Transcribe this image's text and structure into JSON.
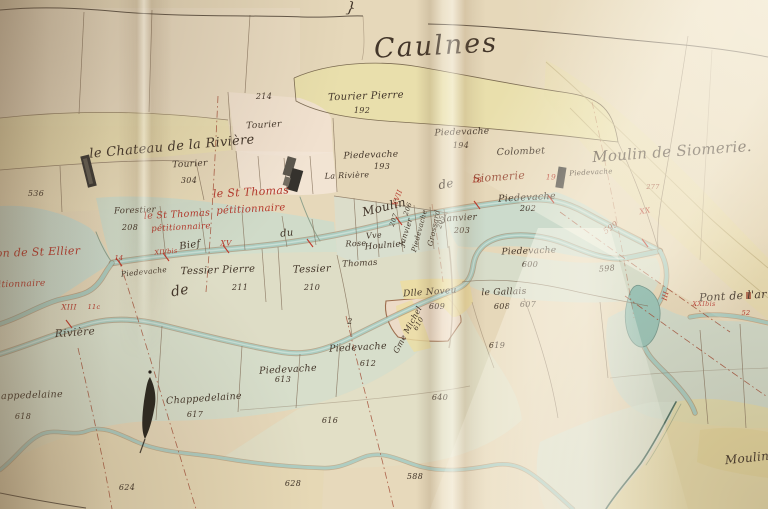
{
  "map": {
    "title": "Caulnes",
    "palette": {
      "ink": "#43362a",
      "red": "#b5382c",
      "redbrown": "#94432e",
      "brown": "#6b503a",
      "paper": "#e4d6b8",
      "water": "#abccc0",
      "meadow": "#cfdfd0",
      "parcel_yellow": "#e9dfaa",
      "parcel_pink": "#f1e1d0"
    },
    "labels": [
      {
        "t": "Caulnes",
        "x": 436,
        "y": 46,
        "fs": 27,
        "c": "ink",
        "r": -3,
        "sp": 2,
        "n": "map-title"
      },
      {
        "t": "}",
        "x": 351,
        "y": 8,
        "fs": 15,
        "c": "ink",
        "r": 8,
        "n": "margin-mark"
      },
      {
        "t": "Moulin de Siomerie.",
        "x": 672,
        "y": 152,
        "fs": 15,
        "c": "ink",
        "r": -4,
        "n": "place-name"
      },
      {
        "t": "le Chateau de la Rivière",
        "x": 172,
        "y": 147,
        "fs": 13,
        "c": "ink",
        "r": -5,
        "n": "place-name"
      },
      {
        "t": "214",
        "x": 264,
        "y": 97,
        "fs": 8,
        "c": "ink"
      },
      {
        "t": "Tourier",
        "x": 264,
        "y": 126,
        "fs": 9,
        "c": "ink",
        "r": -3
      },
      {
        "t": "Tourier Pierre",
        "x": 366,
        "y": 97,
        "fs": 10,
        "c": "ink",
        "r": -2
      },
      {
        "t": "192",
        "x": 362,
        "y": 111,
        "fs": 8,
        "c": "ink"
      },
      {
        "t": "Piedevache",
        "x": 462,
        "y": 133,
        "fs": 9,
        "c": "ink",
        "r": -2
      },
      {
        "t": "194",
        "x": 461,
        "y": 146,
        "fs": 8,
        "c": "ink"
      },
      {
        "t": "Piedevache",
        "x": 371,
        "y": 156,
        "fs": 9,
        "c": "ink",
        "r": -2
      },
      {
        "t": "193",
        "x": 382,
        "y": 167,
        "fs": 8,
        "c": "ink"
      },
      {
        "t": "La Rivière",
        "x": 347,
        "y": 176,
        "fs": 8,
        "c": "ink",
        "r": -2
      },
      {
        "t": "Colombet",
        "x": 521,
        "y": 152,
        "fs": 9.5,
        "c": "ink",
        "r": -2
      },
      {
        "t": "Piedevache",
        "x": 591,
        "y": 173,
        "fs": 7,
        "c": "ink",
        "r": -3
      },
      {
        "t": "Tourier",
        "x": 190,
        "y": 165,
        "fs": 9,
        "c": "ink",
        "r": -3
      },
      {
        "t": "304",
        "x": 189,
        "y": 181,
        "fs": 8,
        "c": "ink"
      },
      {
        "t": "536",
        "x": 36,
        "y": 194,
        "fs": 8,
        "c": "ink"
      },
      {
        "t": "Forestier",
        "x": 135,
        "y": 211,
        "fs": 8.5,
        "c": "ink",
        "r": -2
      },
      {
        "t": "208",
        "x": 130,
        "y": 228,
        "fs": 8,
        "c": "ink"
      },
      {
        "t": "le St Thomas",
        "x": 251,
        "y": 192,
        "fs": 11,
        "c": "red",
        "r": -3,
        "n": "petitioner-annotation"
      },
      {
        "t": "pétitionnaire",
        "x": 251,
        "y": 210,
        "fs": 10,
        "c": "red",
        "r": -3,
        "n": "petitioner-annotation"
      },
      {
        "t": "le St Thomas",
        "x": 177,
        "y": 215,
        "fs": 9.5,
        "c": "red",
        "r": -3,
        "n": "petitioner-annotation"
      },
      {
        "t": "pétitionnaire",
        "x": 181,
        "y": 228,
        "fs": 8.5,
        "c": "red",
        "r": -3,
        "n": "petitioner-annotation"
      },
      {
        "t": "on de St Ellier",
        "x": 38,
        "y": 252,
        "fs": 11,
        "c": "red",
        "r": -2,
        "n": "petitioner-annotation"
      },
      {
        "t": "titionnaire",
        "x": 20,
        "y": 285,
        "fs": 9,
        "c": "red",
        "r": -2,
        "n": "petitioner-annotation"
      },
      {
        "t": "Bief",
        "x": 190,
        "y": 246,
        "fs": 10,
        "c": "ink",
        "r": -8,
        "n": "canal-label"
      },
      {
        "t": "du",
        "x": 287,
        "y": 234,
        "fs": 10,
        "c": "ink",
        "r": -6,
        "n": "canal-label"
      },
      {
        "t": "Moulin",
        "x": 384,
        "y": 207,
        "fs": 12,
        "c": "ink",
        "r": -14,
        "n": "canal-label"
      },
      {
        "t": "de",
        "x": 446,
        "y": 184,
        "fs": 12,
        "c": "ink",
        "r": -10,
        "n": "canal-label"
      },
      {
        "t": "Siomerie",
        "x": 499,
        "y": 177,
        "fs": 11,
        "c": "redbrown",
        "r": -4,
        "n": "canal-label"
      },
      {
        "t": "XIVbis",
        "x": 166,
        "y": 252,
        "fs": 6.5,
        "c": "red",
        "r": -5,
        "n": "station-numeral"
      },
      {
        "t": "XV",
        "x": 226,
        "y": 243,
        "fs": 7.5,
        "c": "red",
        "n": "station-numeral"
      },
      {
        "t": "XVII",
        "x": 398,
        "y": 198,
        "fs": 7,
        "c": "red",
        "r": -70,
        "n": "station-numeral"
      },
      {
        "t": "18",
        "x": 477,
        "y": 180,
        "fs": 7.5,
        "c": "red",
        "n": "station-numeral"
      },
      {
        "t": "19",
        "x": 551,
        "y": 177,
        "fs": 7.5,
        "c": "red",
        "n": "station-numeral"
      },
      {
        "t": "XX",
        "x": 645,
        "y": 211,
        "fs": 7.5,
        "c": "red",
        "r": -10,
        "n": "station-numeral"
      },
      {
        "t": "XIII",
        "x": 69,
        "y": 307,
        "fs": 7.5,
        "c": "red",
        "n": "station-numeral"
      },
      {
        "t": "11c",
        "x": 94,
        "y": 307,
        "fs": 6.5,
        "c": "red",
        "n": "station-numeral"
      },
      {
        "t": "14",
        "x": 119,
        "y": 258,
        "fs": 6.5,
        "c": "red",
        "n": "station-numeral"
      },
      {
        "t": "XXIbis",
        "x": 704,
        "y": 304,
        "fs": 6.5,
        "c": "red",
        "n": "station-numeral"
      },
      {
        "t": "52",
        "x": 746,
        "y": 313,
        "fs": 6.5,
        "c": "red",
        "n": "station-numeral"
      },
      {
        "t": "III",
        "x": 666,
        "y": 296,
        "fs": 7,
        "c": "red",
        "r": -75,
        "n": "station-numeral"
      },
      {
        "t": "Piedevache",
        "x": 527,
        "y": 198,
        "fs": 9.5,
        "c": "ink",
        "r": -3
      },
      {
        "t": "202",
        "x": 528,
        "y": 209,
        "fs": 8,
        "c": "ink"
      },
      {
        "t": "Janvier",
        "x": 460,
        "y": 219,
        "fs": 9,
        "c": "ink",
        "r": -3
      },
      {
        "t": "203",
        "x": 462,
        "y": 231,
        "fs": 8,
        "c": "ink"
      },
      {
        "t": "Janvier",
        "x": 406,
        "y": 232,
        "fs": 7.5,
        "c": "ink",
        "r": -72
      },
      {
        "t": "207",
        "x": 394,
        "y": 220,
        "fs": 6.5,
        "c": "ink",
        "r": -72
      },
      {
        "t": "Piedevache",
        "x": 420,
        "y": 231,
        "fs": 7,
        "c": "ink",
        "r": -75
      },
      {
        "t": "206",
        "x": 408,
        "y": 209,
        "fs": 6.5,
        "c": "ink",
        "r": -70
      },
      {
        "t": "Grossard",
        "x": 434,
        "y": 228,
        "fs": 7.5,
        "c": "ink",
        "r": -78
      },
      {
        "t": "205",
        "x": 441,
        "y": 222,
        "fs": 6.5,
        "c": "ink",
        "r": -75
      },
      {
        "t": "Vve",
        "x": 374,
        "y": 236,
        "fs": 8,
        "c": "ink",
        "r": -5
      },
      {
        "t": "Houlnier",
        "x": 385,
        "y": 246,
        "fs": 8.5,
        "c": "ink",
        "r": -5
      },
      {
        "t": "Rose",
        "x": 356,
        "y": 244,
        "fs": 8,
        "c": "ink",
        "r": -3
      },
      {
        "t": "Thomas",
        "x": 360,
        "y": 264,
        "fs": 8.5,
        "c": "ink",
        "r": -3
      },
      {
        "t": "Tessier Pierre",
        "x": 218,
        "y": 271,
        "fs": 10,
        "c": "ink",
        "r": -2
      },
      {
        "t": "211",
        "x": 240,
        "y": 288,
        "fs": 8,
        "c": "ink"
      },
      {
        "t": "Tessier",
        "x": 312,
        "y": 270,
        "fs": 10,
        "c": "ink",
        "r": -2
      },
      {
        "t": "210",
        "x": 312,
        "y": 288,
        "fs": 8,
        "c": "ink"
      },
      {
        "t": "Piedevache",
        "x": 144,
        "y": 272,
        "fs": 7.5,
        "c": "ink",
        "r": -6
      },
      {
        "t": "de",
        "x": 180,
        "y": 291,
        "fs": 14,
        "c": "ink",
        "r": -10,
        "n": "river-label"
      },
      {
        "t": "Rivière",
        "x": 75,
        "y": 333,
        "fs": 10.5,
        "c": "ink",
        "r": -4,
        "n": "river-label"
      },
      {
        "t": "Piedevache",
        "x": 529,
        "y": 252,
        "fs": 9,
        "c": "ink",
        "r": -2
      },
      {
        "t": "600",
        "x": 530,
        "y": 265,
        "fs": 8,
        "c": "ink"
      },
      {
        "t": "Dlle Noveu",
        "x": 430,
        "y": 293,
        "fs": 9,
        "c": "ink",
        "r": -4
      },
      {
        "t": "609",
        "x": 437,
        "y": 307,
        "fs": 8,
        "c": "ink"
      },
      {
        "t": "le Gallais",
        "x": 504,
        "y": 293,
        "fs": 9,
        "c": "ink",
        "r": -2
      },
      {
        "t": "608",
        "x": 502,
        "y": 307,
        "fs": 8,
        "c": "ink"
      },
      {
        "t": "607",
        "x": 528,
        "y": 305,
        "fs": 8,
        "c": "ink"
      },
      {
        "t": "619",
        "x": 497,
        "y": 346,
        "fs": 8,
        "c": "ink"
      },
      {
        "t": "Gme Michel",
        "x": 408,
        "y": 330,
        "fs": 8,
        "c": "ink",
        "r": -62
      },
      {
        "t": "610",
        "x": 419,
        "y": 324,
        "fs": 7,
        "c": "ink",
        "r": -62
      },
      {
        "t": "Piedevache",
        "x": 358,
        "y": 348,
        "fs": 9.5,
        "c": "ink",
        "r": -3
      },
      {
        "t": "612",
        "x": 368,
        "y": 364,
        "fs": 8,
        "c": "ink"
      },
      {
        "t": "Piedevache",
        "x": 288,
        "y": 370,
        "fs": 9.5,
        "c": "ink",
        "r": -3
      },
      {
        "t": "613",
        "x": 283,
        "y": 380,
        "fs": 8,
        "c": "ink"
      },
      {
        "t": "640",
        "x": 440,
        "y": 398,
        "fs": 8,
        "c": "ink"
      },
      {
        "t": "616",
        "x": 330,
        "y": 421,
        "fs": 8,
        "c": "ink"
      },
      {
        "t": "Chappedelaine",
        "x": 25,
        "y": 396,
        "fs": 9.5,
        "c": "ink",
        "r": -2
      },
      {
        "t": "618",
        "x": 23,
        "y": 417,
        "fs": 8,
        "c": "ink"
      },
      {
        "t": "Chappedelaine",
        "x": 204,
        "y": 399,
        "fs": 9.5,
        "c": "ink",
        "r": -4
      },
      {
        "t": "617",
        "x": 195,
        "y": 415,
        "fs": 8,
        "c": "ink"
      },
      {
        "t": "624",
        "x": 127,
        "y": 488,
        "fs": 8,
        "c": "ink"
      },
      {
        "t": "628",
        "x": 293,
        "y": 484,
        "fs": 8,
        "c": "ink"
      },
      {
        "t": "588",
        "x": 415,
        "y": 477,
        "fs": 8,
        "c": "ink"
      },
      {
        "t": "598",
        "x": 607,
        "y": 269,
        "fs": 8,
        "c": "ink",
        "r": -5
      },
      {
        "t": "599",
        "x": 611,
        "y": 228,
        "fs": 8,
        "c": "redbrown",
        "r": -35
      },
      {
        "t": "277",
        "x": 653,
        "y": 187,
        "fs": 6.5,
        "c": "redbrown"
      },
      {
        "t": "2",
        "x": 350,
        "y": 322,
        "fs": 8,
        "c": "ink"
      },
      {
        "t": "Pont de l'ar",
        "x": 733,
        "y": 296,
        "fs": 11,
        "c": "ink",
        "r": -3,
        "n": "place-name"
      },
      {
        "t": "Moulin",
        "x": 747,
        "y": 458,
        "fs": 12,
        "c": "ink",
        "r": -6,
        "n": "place-name"
      }
    ]
  }
}
